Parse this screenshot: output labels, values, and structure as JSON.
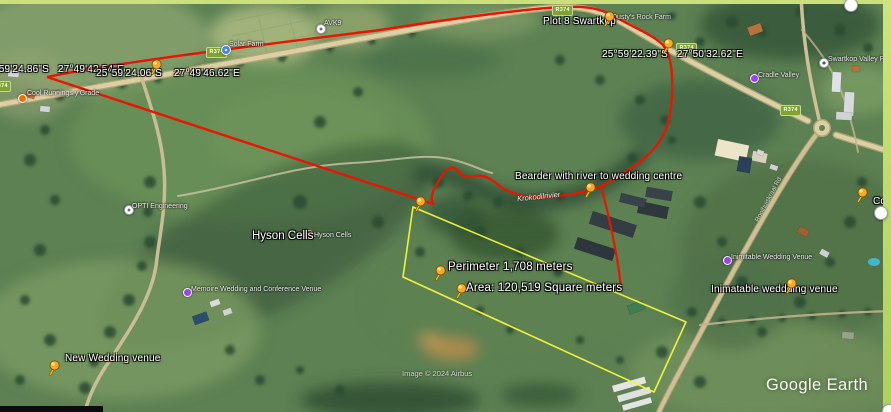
{
  "app": {
    "watermark": "Google Earth",
    "attribution": "Image © 2024 Airbus"
  },
  "map": {
    "river_label": "Krokodilrivier",
    "road_name_label": "Rooihuiskraal Rd",
    "area_name_label": "Hyson Cells",
    "colors": {
      "measure_path_red": "#ea1500",
      "measure_polygon_yellow": "#f8f73c",
      "pushpin_yellow": "#f9a825",
      "road_badge_green": "#7fa32b",
      "selection_border": "#cbe07a"
    },
    "measurements": {
      "perimeter": "Perimeter 1,708 meters",
      "area": "Area: 120,519 Square meters"
    },
    "placemarks": [
      {
        "name": "coords-left-cut",
        "label": "25°59'24.86\"S   27°49'42.54\"E",
        "label_x": -17,
        "label_y": 64,
        "pin_x": null,
        "pin_y": null,
        "metric": false
      },
      {
        "name": "coords-west",
        "label": "25°59'24.06\"S    27°49'46.62\"E",
        "label_x": 96,
        "label_y": 68,
        "pin_x": 152,
        "pin_y": 73,
        "metric": false
      },
      {
        "name": "plot-8-swartkop",
        "label": "Plot 8 Swartkop",
        "label_x": 543,
        "label_y": 16,
        "pin_x": 605,
        "pin_y": 25,
        "metric": false
      },
      {
        "name": "coords-east",
        "label": "25°59'22.39\"S   27°50'32.62\"E",
        "label_x": 602,
        "label_y": 49,
        "pin_x": 664,
        "pin_y": 52,
        "metric": false
      },
      {
        "name": "bearder-river",
        "label": "Bearder with river to wedding centre",
        "label_x": 515,
        "label_y": 171,
        "pin_x": 586,
        "pin_y": 196,
        "metric": false
      },
      {
        "name": "perimeter",
        "label": "Perimeter 1,708 meters",
        "label_x": 448,
        "label_y": 261,
        "pin_x": 436,
        "pin_y": 279,
        "metric": true
      },
      {
        "name": "area",
        "label": "Area: 120,519 Square meters",
        "label_x": 466,
        "label_y": 282,
        "pin_x": 457,
        "pin_y": 297,
        "metric": true
      },
      {
        "name": "inimatable-venue",
        "label": "Inimatable weddding venue",
        "label_x": 711,
        "label_y": 284,
        "pin_x": 787,
        "pin_y": 292,
        "metric": false
      },
      {
        "name": "new-wedding-venue",
        "label": "New Wedding venue",
        "label_x": 65,
        "label_y": 353,
        "pin_x": 50,
        "pin_y": 374,
        "metric": false
      },
      {
        "name": "co-right-edge",
        "label": "Co",
        "label_x": 873,
        "label_y": 196,
        "pin_x": 858,
        "pin_y": 201,
        "metric": false
      },
      {
        "name": "polygon-corner",
        "label": "",
        "label_x": 0,
        "label_y": 0,
        "pin_x": 416,
        "pin_y": 210,
        "metric": false
      }
    ],
    "poi_labels": [
      {
        "name": "cool-runnings",
        "icon": "orange-circle",
        "label": "Cool Runnings y'Grade",
        "icon_x": 18,
        "icon_y": 94,
        "label_x": 27,
        "label_y": 90
      },
      {
        "name": "solar-farm",
        "icon": "blue-circle",
        "label": "Solar Farm",
        "icon_x": 221,
        "icon_y": 45,
        "label_x": 229,
        "label_y": 41
      },
      {
        "name": "avk",
        "icon": "white-circle",
        "label": "AVK9",
        "icon_x": 316,
        "icon_y": 24,
        "label_x": 324,
        "label_y": 20
      },
      {
        "name": "rock-farm",
        "icon": "none",
        "label": "Dusty's Rock Farm",
        "icon_x": 0,
        "icon_y": 0,
        "label_x": 612,
        "label_y": 14
      },
      {
        "name": "swartkop-valley-prim",
        "icon": "school-circle",
        "label": "Swartkop Valley Prim",
        "icon_x": 819,
        "icon_y": 58,
        "label_x": 828,
        "label_y": 56
      },
      {
        "name": "cradle-valley",
        "icon": "purple-dot",
        "label": "Cradle Valley",
        "icon_x": 750,
        "icon_y": 74,
        "label_x": 758,
        "label_y": 72
      },
      {
        "name": "opti-engineering",
        "icon": "white-circle",
        "label": "OPTI Engineering",
        "icon_x": 124,
        "icon_y": 205,
        "label_x": 132,
        "label_y": 203
      },
      {
        "name": "hyson-cells-poi",
        "icon": "red-pin",
        "label": "Hyson Cells",
        "icon_x": 305,
        "icon_y": 228,
        "label_x": 314,
        "label_y": 232
      },
      {
        "name": "memoire-venue",
        "icon": "purple-dot",
        "label": "Memoire Wedding and Conference Venue",
        "icon_x": 183,
        "icon_y": 288,
        "label_x": 191,
        "label_y": 286
      },
      {
        "name": "inimitable-venue-poi",
        "icon": "purple-dot",
        "label": "Inimitable Wedding Venue",
        "icon_x": 723,
        "icon_y": 256,
        "label_x": 731,
        "label_y": 254
      }
    ],
    "road_badges": [
      {
        "text": "R374",
        "x": 206,
        "y": 47
      },
      {
        "text": "R374",
        "x": 552,
        "y": 5
      },
      {
        "text": "R374",
        "x": 676,
        "y": 43
      },
      {
        "text": "R374",
        "x": 780,
        "y": 105
      },
      {
        "text": "R374",
        "x": -10,
        "y": 81
      }
    ]
  }
}
